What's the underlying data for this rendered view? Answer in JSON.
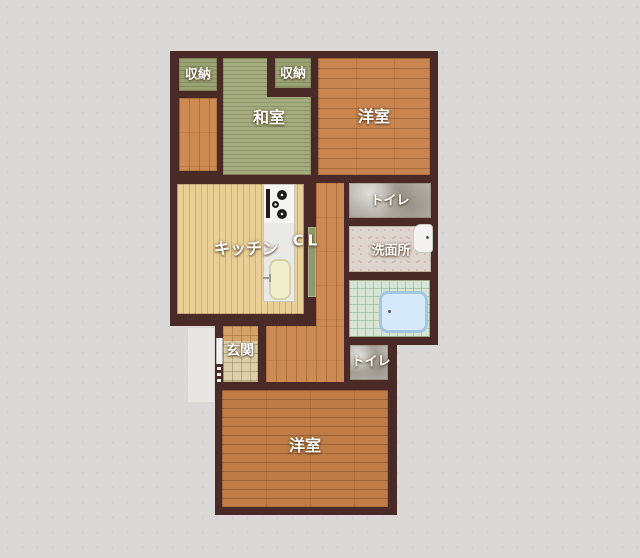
{
  "plan": {
    "kind": "apartment-floor-plan"
  },
  "labels": {
    "closet_left": "収納",
    "closet_right": "収納",
    "japanese_room": "和室",
    "western_room_top": "洋室",
    "toilet_upper": "トイレ",
    "washroom": "洗面所",
    "kitchen": "キッチン",
    "hall_closet": "CL",
    "entrance": "玄関",
    "toilet_lower": "トイレ",
    "western_room_bottom": "洋室"
  },
  "colors": {
    "background": "#dad9d7",
    "wall": "#4a2a26",
    "tatami": "#a4ac7f",
    "wood_orange": "#c8854f",
    "wood_orange_dark": "#bf7c46",
    "wood_hall": "#cb8b52",
    "wood_kitchen": "#e7cf96",
    "entrance_tile": "#dccfab",
    "marble": "#b8b4ab",
    "washroom_floor": "#ded5cf",
    "bath_tile": "#d6e4d3",
    "bathtub": "#d6eafb",
    "label_text": "#ffffff"
  }
}
